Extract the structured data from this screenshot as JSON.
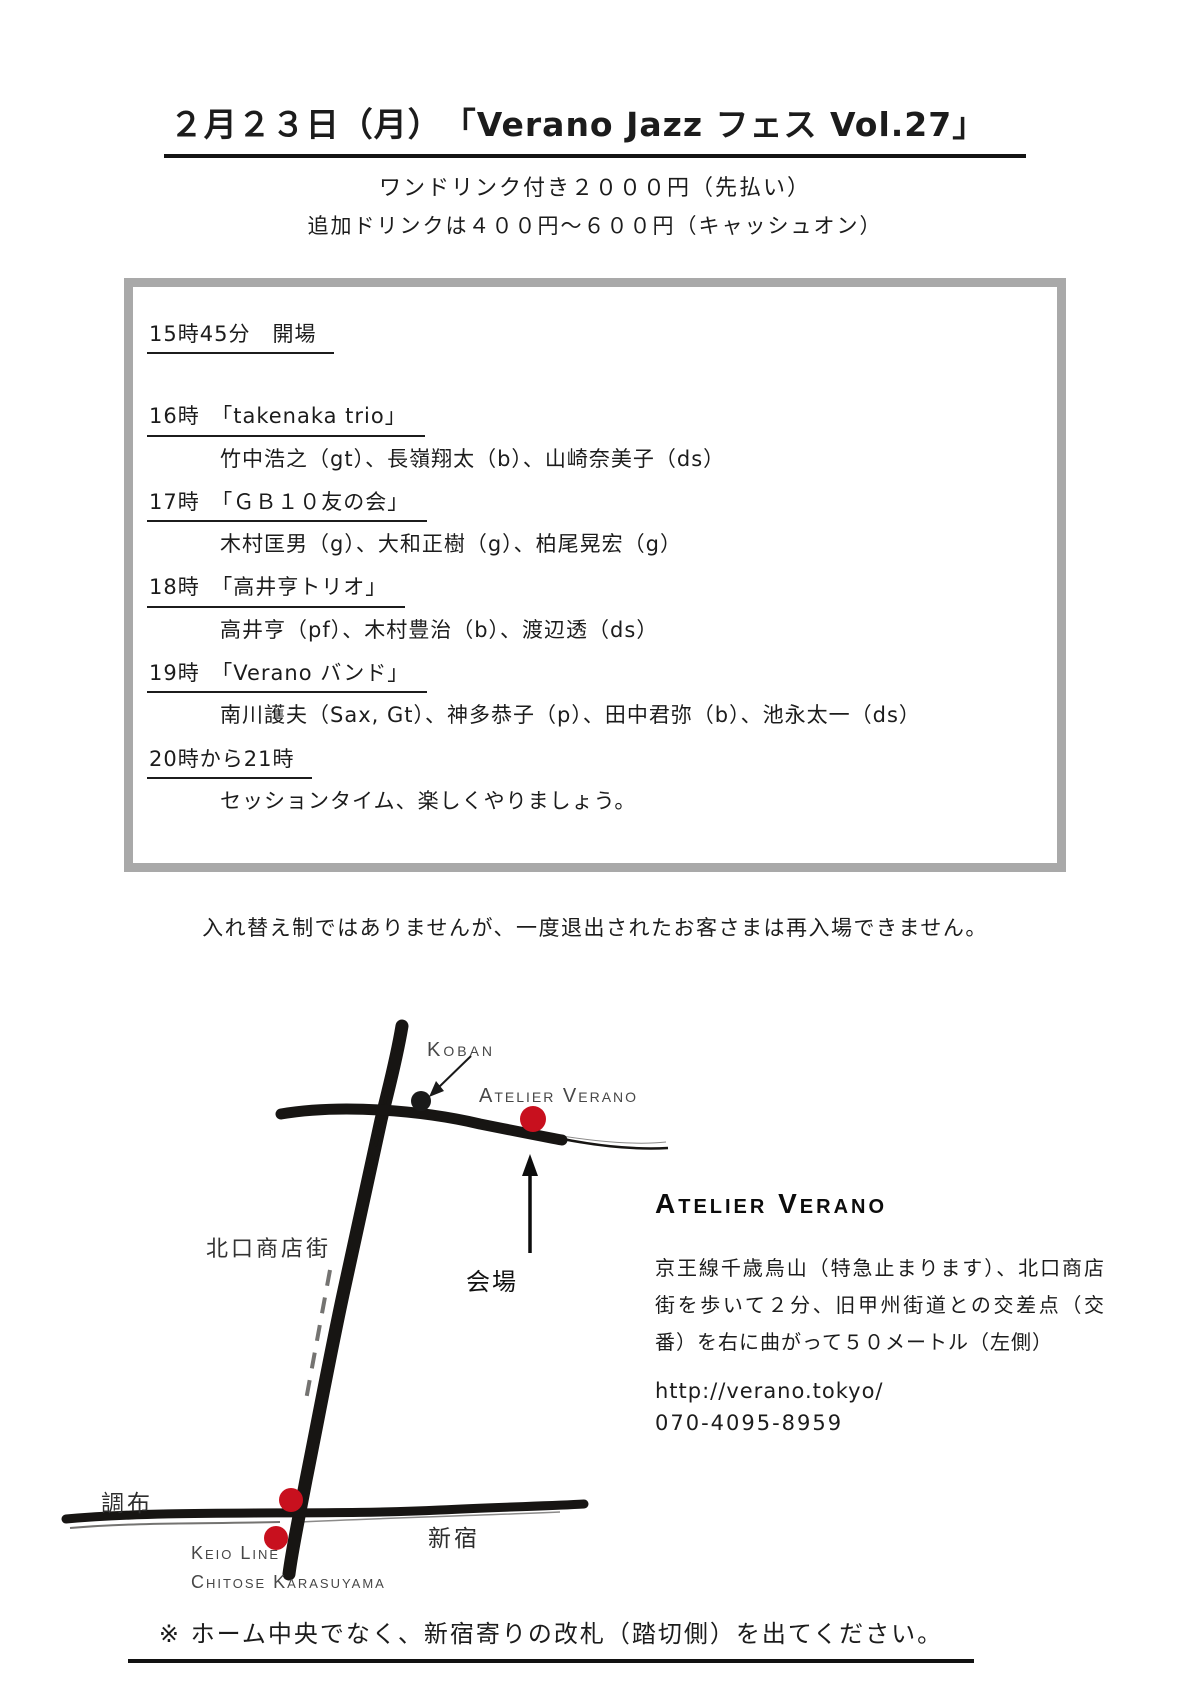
{
  "flyer": {
    "title": "２月２３日（月）　「Verano Jazz フェス Vol.27」",
    "subtitle1": "ワンドリンク付き２０００円（先払い）",
    "subtitle2": "追加ドリンクは４００円～６００円（キャッシュオン）",
    "schedule": {
      "entries": [
        {
          "heading": "15時45分　開場"
        },
        {
          "heading": "16時　「takenaka trio」",
          "members": "竹中浩之（gt）、長嶺翔太（b）、山崎奈美子（ds）"
        },
        {
          "heading": "17時　「ＧＢ１０友の会」",
          "members": "木村匡男（g）、大和正樹（g）、柏尾晃宏（g）"
        },
        {
          "heading": "18時　「高井亨トリオ」",
          "members": "高井亨（pf）、木村豊治（b）、渡辺透（ds）"
        },
        {
          "heading": "19時　「Verano バンド」",
          "members": "南川護夫（Sax, Gt）、神多恭子（p）、田中君弥（b）、池永太一（ds）"
        },
        {
          "heading": "20時から21時",
          "members": "セッションタイム、楽しくやりましょう。"
        }
      ]
    },
    "notice": "入れ替え制ではありませんが、一度退出されたお客さまは再入場できません。",
    "map": {
      "labels": {
        "koban": "Koban",
        "venue_en": "Atelier Verano",
        "venue_ja": "会場",
        "north_shopping_street": "北口商店街",
        "chofu": "調布",
        "shinjuku": "新宿",
        "keio_line": "Keio Line",
        "chitose_karasuyama": "Chitose Karasuyama"
      },
      "colors": {
        "marker_red": "#c8101e",
        "marker_black": "#1a1a1a",
        "road_black": "#171513",
        "label_gray": "#474747"
      }
    },
    "venue_info": {
      "name": "Atelier Verano",
      "access": "京王線千歳烏山（特急止まります）、北口商店街を歩いて２分、旧甲州街道との交差点（交番）を右に曲がって５０メートル（左側）",
      "url": "http://verano.tokyo/",
      "phone": "070-4095-8959"
    },
    "footer_note": "※ ホーム中央でなく、新宿寄りの改札（踏切側）を出てください。",
    "colors": {
      "box_border": "#a9a9a9",
      "text": "#1c1c1c"
    }
  }
}
